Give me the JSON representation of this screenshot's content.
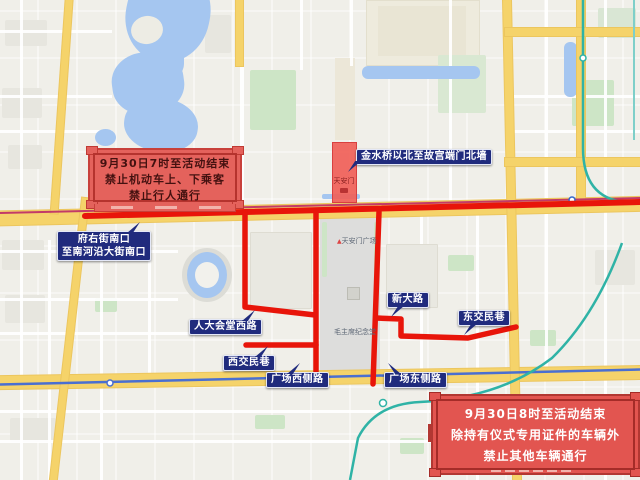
{
  "notices": {
    "top_left": {
      "line1": "9月30日7时至活动结束",
      "line2": "禁止机动车上、下乘客",
      "line3": "禁止行人通行"
    },
    "bottom_right": {
      "line1": "9月30日8时至活动结束",
      "line2": "除持有仪式专用证件的车辆外",
      "line3": "禁止其他车辆通行"
    }
  },
  "zone_label": {
    "text": "金水桥以北至故宫端门北墙"
  },
  "road_labels": {
    "fuyou": {
      "line1": "府右街南口",
      "line2": "至南河沿大街南口"
    },
    "renda_west": {
      "text": "人大会堂西路"
    },
    "xijiaomin": {
      "text": "西交民巷"
    },
    "square_west": {
      "text": "广场西侧路"
    },
    "square_east": {
      "text": "广场东侧路"
    },
    "xindalu": {
      "text": "新大路"
    },
    "dongjiaomin": {
      "text": "东交民巷"
    }
  },
  "map_pois": {
    "tiananmen_square": "天安门广场",
    "memorial_hall": "毛主席纪念堂",
    "tiananmen_gate": "天安门"
  },
  "colors": {
    "closure_red": "#e8150a",
    "label_navy": "#202b7d",
    "notice_fill": "#e4625c",
    "highlight_zone": "#f05f58",
    "road_yellow": "#f5d36a",
    "water_blue": "#a5c6f0",
    "park_green": "#cde5c6",
    "metro_teal": "#2fb3a6",
    "metro_blue": "#4a6fd1",
    "metro_crimson": "#c23a68"
  }
}
